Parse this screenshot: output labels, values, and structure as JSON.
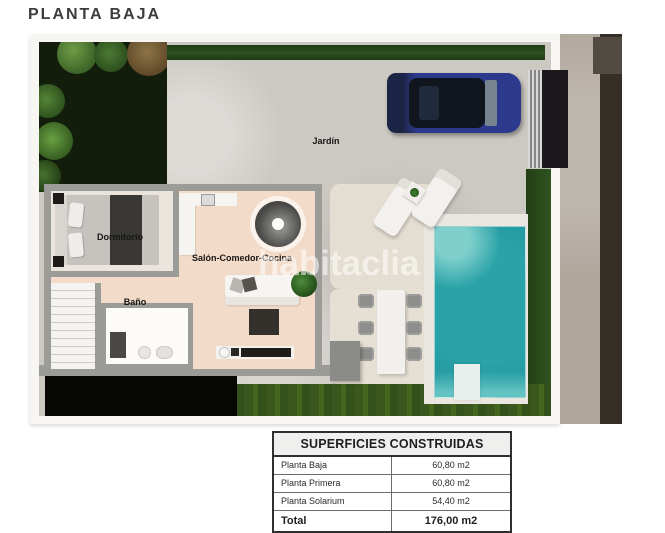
{
  "title": "PLANTA BAJA",
  "plan": {
    "labels": {
      "jardin": "Jardín",
      "dormitorio": "Dormitorio",
      "salon": "Salón-Comedor-Cocina",
      "bano": "Baño"
    },
    "watermark": "habitaclia",
    "colors": {
      "pool": "#2aa2a7",
      "car": "#2c3a8e",
      "grass": "#3a581d",
      "hedge": "#27481a",
      "paving": "#ccc8c2",
      "interior_floor": "#f2dbc9",
      "wall": "#9b9b98",
      "road": "#352e27",
      "sidewalk": "#b0a79d"
    }
  },
  "table": {
    "header": "SUPERFICIES CONSTRUIDAS",
    "rows": [
      {
        "label": "Planta Baja",
        "value": "60,80 m2"
      },
      {
        "label": "Planta Primera",
        "value": "60,80 m2"
      },
      {
        "label": "Planta Solarium",
        "value": "54,40 m2"
      }
    ],
    "total_label": "Total",
    "total_value": "176,00 m2"
  }
}
